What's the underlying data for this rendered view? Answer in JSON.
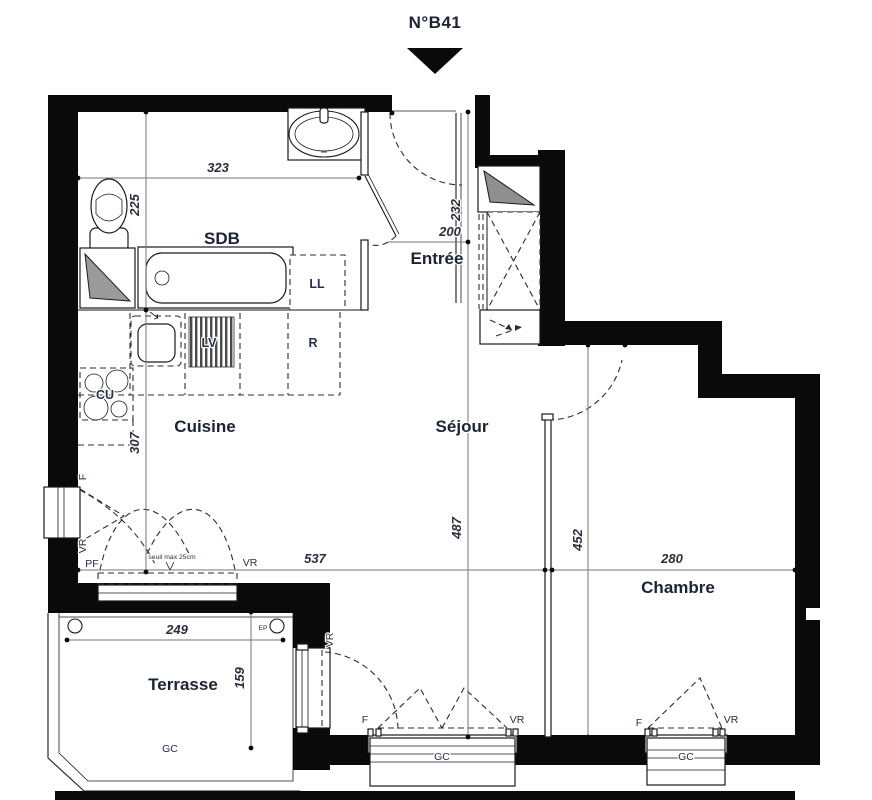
{
  "title": {
    "label": "N°B41"
  },
  "rooms": {
    "sdb": "SDB",
    "entree": "Entrée",
    "cuisine": "Cuisine",
    "sejour": "Séjour",
    "chambre": "Chambre",
    "terrasse": "Terrasse"
  },
  "appliances": {
    "washing_machine": "LL",
    "dishwasher": "LV",
    "fridge": "R",
    "hob": "CU"
  },
  "openings": {
    "window": "F",
    "roller_shutter": "VR",
    "french_door": "PF",
    "threshold_note": "seuil max 25cm"
  },
  "annotations": {
    "guardrail": "GC",
    "rain_pipe": "EP"
  },
  "dimensions": {
    "sdb_width": "323",
    "sdb_depth": "225",
    "entry_depth": "232",
    "entry_width": "200",
    "kitchen_depth": "307",
    "living_depth": "487",
    "bedroom_depth": "452",
    "living_width": "537",
    "bedroom_width": "280",
    "terrace_width": "249",
    "terrace_depth": "159"
  },
  "colors": {
    "wall": "#0a0a0a",
    "label": "#1b2335",
    "dimension": "#2c2c3e"
  }
}
